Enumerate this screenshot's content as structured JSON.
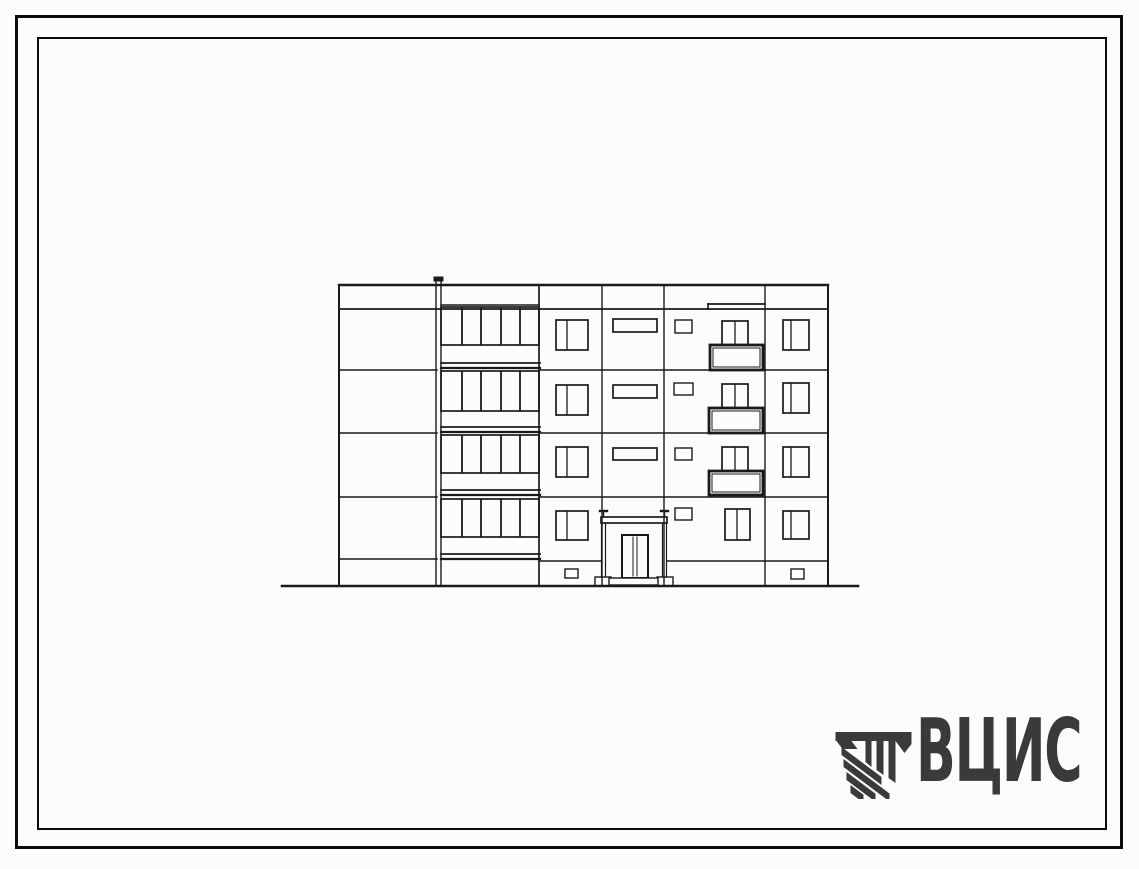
{
  "colors": {
    "paper": "#fcfcfc",
    "frame": "#0b0b0b",
    "ink": "#1a1a1a",
    "logo": "#3a3a3c"
  },
  "logo": {
    "text": "ВЦИС"
  },
  "sheet": {
    "type": "building-elevation-drawing",
    "storeys": 4,
    "width": 1139,
    "height": 869
  },
  "drawing": {
    "rects": [
      [
        "pipe-cap",
        434,
        277,
        9,
        4,
        1,
        "dark"
      ],
      [
        "loggia-glazing-floor1",
        441,
        307,
        98,
        38,
        1.7,
        ""
      ],
      [
        "loggia-glazing-floor2",
        441,
        371,
        98,
        40,
        1.7,
        ""
      ],
      [
        "loggia-glazing-floor3",
        441,
        435,
        98,
        38,
        1.7,
        ""
      ],
      [
        "loggia-glazing-floor4",
        441,
        499,
        98,
        38,
        1.7,
        ""
      ],
      [
        "window-a-floor1",
        556,
        320,
        32,
        30,
        1.7,
        ""
      ],
      [
        "window-a-floor2",
        556,
        385,
        32,
        30,
        1.7,
        ""
      ],
      [
        "window-a-floor3",
        556,
        447,
        32,
        30,
        1.7,
        ""
      ],
      [
        "window-a-floor4",
        556,
        511,
        32,
        29,
        1.7,
        ""
      ],
      [
        "ribbon-window-floor1",
        613,
        319,
        44,
        13,
        1.7,
        ""
      ],
      [
        "ribbon-window-floor2",
        613,
        385,
        44,
        13,
        1.7,
        ""
      ],
      [
        "ribbon-window-floor3",
        613,
        448,
        44,
        12,
        1.7,
        ""
      ],
      [
        "small-window-floor1",
        675,
        320,
        17,
        13,
        1.4,
        ""
      ],
      [
        "small-window-floor2",
        674,
        383,
        19,
        12,
        1.4,
        ""
      ],
      [
        "small-window-floor3",
        675,
        448,
        17,
        12,
        1.4,
        ""
      ],
      [
        "small-window-floor4",
        675,
        508,
        17,
        12,
        1.4,
        ""
      ],
      [
        "balcony-window-floor1",
        722,
        321,
        26,
        25,
        1.7,
        ""
      ],
      [
        "balcony-window-floor2",
        722,
        384,
        26,
        25,
        1.7,
        ""
      ],
      [
        "balcony-window-floor3",
        722,
        447,
        26,
        25,
        1.7,
        ""
      ],
      [
        "window-c-floor4",
        725,
        509,
        25,
        31,
        1.7,
        ""
      ],
      [
        "balcony-floor1",
        710,
        345,
        53,
        25,
        2.8,
        "white"
      ],
      [
        "balcony-floor1-inner",
        713,
        348,
        47,
        19,
        1,
        ""
      ],
      [
        "balcony-floor2",
        709,
        408,
        54,
        25,
        2.8,
        "white"
      ],
      [
        "balcony-floor2-inner",
        712,
        411,
        48,
        19,
        1,
        ""
      ],
      [
        "balcony-floor3",
        709,
        471,
        54,
        24,
        2.8,
        "white"
      ],
      [
        "balcony-floor3-inner",
        712,
        474,
        48,
        18,
        1,
        ""
      ],
      [
        "window-d-floor1",
        783,
        320,
        26,
        30,
        1.7,
        ""
      ],
      [
        "window-d-floor2",
        783,
        383,
        26,
        30,
        1.7,
        ""
      ],
      [
        "window-d-floor3",
        783,
        447,
        26,
        30,
        1.7,
        ""
      ],
      [
        "window-d-floor4",
        783,
        511,
        26,
        28,
        1.7,
        ""
      ],
      [
        "basement-window-left",
        565,
        569,
        13,
        9,
        1.4,
        ""
      ],
      [
        "basement-window-right",
        791,
        569,
        13,
        10,
        1.4,
        ""
      ],
      [
        "porch-canopy",
        601,
        517,
        66,
        6,
        1.7,
        "white"
      ],
      [
        "porch-base-left",
        595,
        577,
        16,
        9,
        1.4,
        "white"
      ],
      [
        "porch-base-right",
        657,
        577,
        16,
        9,
        1.4,
        "white"
      ],
      [
        "entrance-door",
        622,
        535,
        26,
        43,
        2,
        "white"
      ],
      [
        "entrance-step",
        609,
        578,
        49,
        7,
        1.4,
        "white"
      ]
    ],
    "lines": [
      [
        "roof-line",
        339,
        285,
        828,
        285,
        2.4
      ],
      [
        "parapet-line",
        339,
        309,
        828,
        309,
        1.7
      ],
      [
        "loggia-parapet-top",
        441,
        305,
        539,
        305,
        1.5
      ],
      [
        "parapet-step-c",
        708,
        304,
        765,
        304,
        1.7
      ],
      [
        "parapet-step-c-v",
        708,
        304,
        708,
        309,
        1.7
      ],
      [
        "floor-line1-left",
        339,
        370,
        437,
        370,
        1.5
      ],
      [
        "floor-line1-right",
        539,
        370,
        828,
        370,
        1.5
      ],
      [
        "floor-line2-left",
        339,
        433,
        437,
        433,
        1.5
      ],
      [
        "floor-line2-right",
        539,
        433,
        828,
        433,
        1.5
      ],
      [
        "floor-line3-left",
        339,
        497,
        437,
        497,
        1.5
      ],
      [
        "floor-line3-right",
        539,
        497,
        828,
        497,
        1.5
      ],
      [
        "plinth-line-left",
        339,
        559,
        437,
        559,
        1.4
      ],
      [
        "plinth-line-mid",
        539,
        561,
        601,
        561,
        1.4
      ],
      [
        "plinth-line-right",
        667,
        561,
        828,
        561,
        1.4
      ],
      [
        "ground-line",
        282,
        586,
        858,
        586,
        2.6
      ],
      [
        "loggia-slab1-top",
        441,
        363,
        540,
        363,
        1.8
      ],
      [
        "loggia-slab1-bottom",
        441,
        368,
        540,
        368,
        2.2
      ],
      [
        "loggia-slab2-top",
        441,
        427,
        540,
        427,
        1.8
      ],
      [
        "loggia-slab2-bottom",
        441,
        432,
        540,
        432,
        2.2
      ],
      [
        "loggia-slab3-top",
        441,
        490,
        540,
        490,
        1.8
      ],
      [
        "loggia-slab3-bottom",
        441,
        495,
        540,
        495,
        2.2
      ],
      [
        "loggia-slab4-top",
        441,
        554,
        540,
        554,
        1.8
      ],
      [
        "loggia-slab4-bottom",
        441,
        559,
        540,
        559,
        2.2
      ],
      [
        "building-left-edge",
        339,
        285,
        339,
        586,
        2
      ],
      [
        "drainpipe-left",
        436,
        281,
        436,
        586,
        1.4
      ],
      [
        "drainpipe-right",
        441,
        281,
        441,
        586,
        1.4
      ],
      [
        "loggia-right-edge",
        539,
        285,
        539,
        586,
        1.7
      ],
      [
        "panel-joint-1",
        602,
        285,
        602,
        586,
        1.4
      ],
      [
        "panel-joint-2",
        664,
        285,
        664,
        586,
        1.4
      ],
      [
        "panel-joint-3",
        765,
        285,
        765,
        586,
        1.4
      ],
      [
        "building-right-edge",
        828,
        285,
        828,
        586,
        2
      ],
      [
        "glazing-mullion-f1-1",
        462,
        308,
        462,
        344,
        1.8
      ],
      [
        "glazing-mullion-f1-2",
        481,
        308,
        481,
        344,
        1.8
      ],
      [
        "glazing-mullion-f1-3",
        501,
        308,
        501,
        344,
        1.8
      ],
      [
        "glazing-mullion-f1-4",
        520,
        308,
        520,
        344,
        1.8
      ],
      [
        "glazing-mullion-f2-1",
        462,
        372,
        462,
        410,
        1.8
      ],
      [
        "glazing-mullion-f2-2",
        481,
        372,
        481,
        410,
        1.8
      ],
      [
        "glazing-mullion-f2-3",
        501,
        372,
        501,
        410,
        1.8
      ],
      [
        "glazing-mullion-f2-4",
        520,
        372,
        520,
        410,
        1.8
      ],
      [
        "glazing-mullion-f3-1",
        462,
        436,
        462,
        472,
        1.8
      ],
      [
        "glazing-mullion-f3-2",
        481,
        436,
        481,
        472,
        1.8
      ],
      [
        "glazing-mullion-f3-3",
        501,
        436,
        501,
        472,
        1.8
      ],
      [
        "glazing-mullion-f3-4",
        520,
        436,
        520,
        472,
        1.8
      ],
      [
        "glazing-mullion-f4-1",
        462,
        500,
        462,
        536,
        1.8
      ],
      [
        "glazing-mullion-f4-2",
        481,
        500,
        481,
        536,
        1.8
      ],
      [
        "glazing-mullion-f4-3",
        501,
        500,
        501,
        536,
        1.8
      ],
      [
        "glazing-mullion-f4-4",
        520,
        500,
        520,
        536,
        1.8
      ],
      [
        "window-a-divider-f1",
        567,
        321,
        567,
        349,
        1.3
      ],
      [
        "window-a-divider-f2",
        567,
        386,
        567,
        414,
        1.3
      ],
      [
        "window-a-divider-f3",
        567,
        448,
        567,
        476,
        1.3
      ],
      [
        "window-a-divider-f4",
        567,
        512,
        567,
        539,
        1.3
      ],
      [
        "window-d-divider-f1",
        791,
        321,
        791,
        349,
        1.3
      ],
      [
        "window-d-divider-f2",
        791,
        384,
        791,
        412,
        1.3
      ],
      [
        "window-d-divider-f3",
        791,
        448,
        791,
        476,
        1.3
      ],
      [
        "window-d-divider-f4",
        791,
        512,
        791,
        538,
        1.3
      ],
      [
        "balcony-window-divider-f1",
        735,
        322,
        735,
        345,
        1.3
      ],
      [
        "balcony-window-divider-f2",
        735,
        385,
        735,
        408,
        1.3
      ],
      [
        "balcony-window-divider-f3",
        735,
        448,
        735,
        471,
        1.3
      ],
      [
        "window-c-divider-f4",
        737,
        510,
        737,
        539,
        1.3
      ],
      [
        "door-leaf-left-edge",
        633,
        537,
        633,
        576,
        1
      ],
      [
        "door-leaf-right-edge",
        637,
        537,
        637,
        576,
        1
      ],
      [
        "porch-post-left-outer",
        601.5,
        523,
        601.5,
        577,
        1.2
      ],
      [
        "porch-post-left-inner",
        605.5,
        523,
        605.5,
        577,
        1.2
      ],
      [
        "porch-post-right-inner",
        662.5,
        523,
        662.5,
        577,
        1.2
      ],
      [
        "porch-post-right-outer",
        666.5,
        523,
        666.5,
        577,
        1.2
      ],
      [
        "porch-post-left-stem",
        603.5,
        511,
        603.5,
        517,
        1.4
      ],
      [
        "porch-post-right-stem",
        664.5,
        511,
        664.5,
        517,
        1.4
      ],
      [
        "porch-post-left-cap",
        600,
        511,
        607,
        511,
        2.4
      ],
      [
        "porch-post-right-cap",
        661,
        511,
        668,
        511,
        2.4
      ]
    ]
  }
}
